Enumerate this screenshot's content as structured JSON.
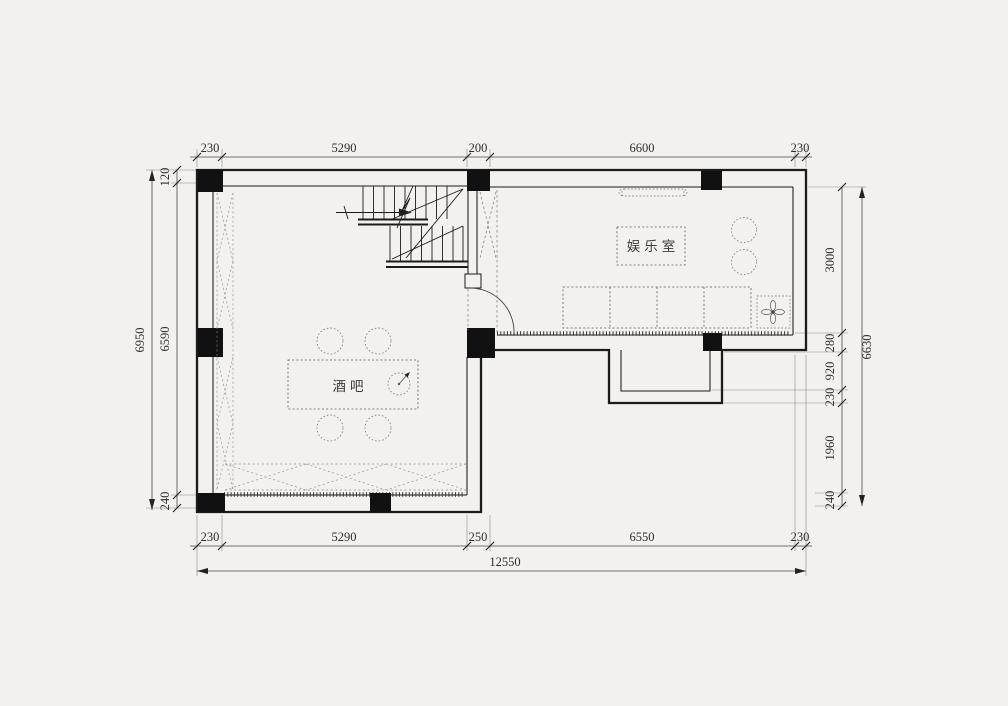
{
  "drawing_type": "floor-plan",
  "rooms": {
    "entertainment": "娱乐室",
    "bar": "酒吧"
  },
  "dims": {
    "top": [
      "230",
      "5290",
      "200",
      "6600",
      "230"
    ],
    "bottom": [
      "230",
      "5290",
      "250",
      "6550",
      "230"
    ],
    "left": [
      "120",
      "6590",
      "240"
    ],
    "right": [
      "3000",
      "280",
      "920",
      "230",
      "1960",
      "240"
    ],
    "overall": {
      "width": "12550",
      "height_left": "6950",
      "height_right": "6630"
    }
  },
  "symbols": [
    "column",
    "stair",
    "door-swing",
    "sofa",
    "bar-counter",
    "stool",
    "tv",
    "fan"
  ],
  "colors": {
    "background": "#f2f1ee",
    "wall": "#1b1b1b",
    "dimension": "#4a4a4a",
    "furniture": "#5a5a5a"
  }
}
